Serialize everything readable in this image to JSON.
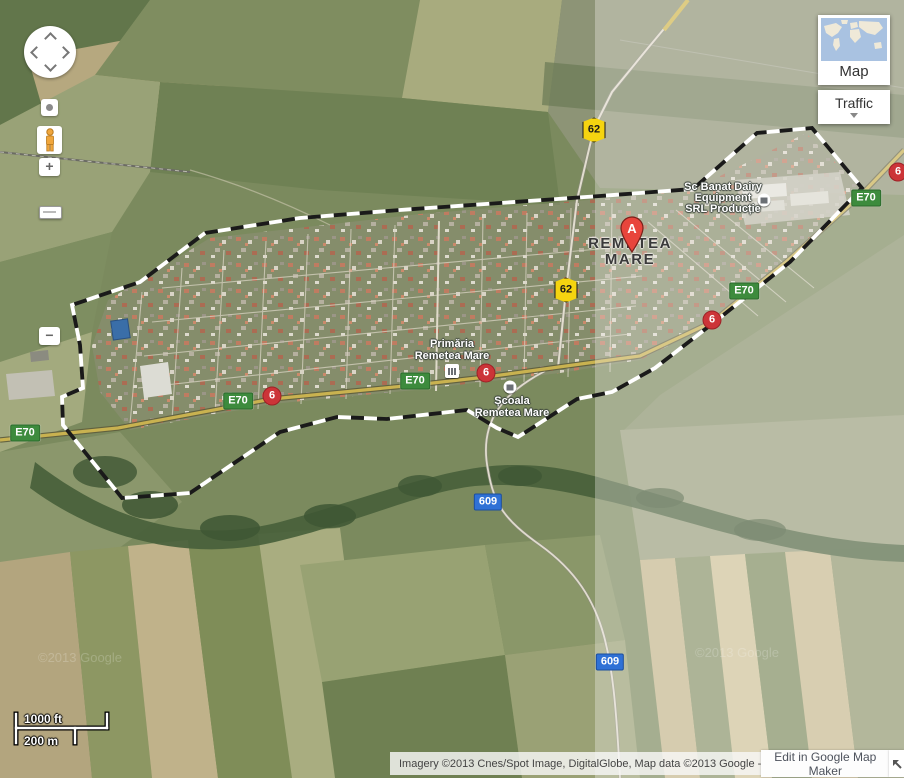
{
  "controls": {
    "zoom_in": "+",
    "zoom_out": "−"
  },
  "widgets": {
    "map_button": "Map",
    "traffic_button": "Traffic"
  },
  "road_badges": {
    "e70": "E70",
    "dn6": "6",
    "dn62": "62",
    "dj609": "609"
  },
  "marker": {
    "label": "A"
  },
  "place_labels": {
    "town_line1": "REMETEA",
    "town_line2": "MARE",
    "factory_line1": "Sc Banat Dairy",
    "factory_line2": "Equipment",
    "factory_line3": "SRL Producție",
    "cityhall_line1": "Primăria",
    "cityhall_line2": "Remetea Mare",
    "school_line1": "Școala",
    "school_line2": "Remetea Mare"
  },
  "scale_bar": {
    "imperial": "1000 ft",
    "metric": "200 m"
  },
  "attribution": {
    "imagery": "Imagery ©2013 Cnes/Spot Image, DigitalGlobe, Map data ©2013 Google -",
    "edit_button": "Edit in Google Map Maker"
  },
  "watermark": "©2013 Google",
  "colors": {
    "euro_badge": "#3d8b3d",
    "national_badge": "#cc3438",
    "county_badge": "#f5d410",
    "local_badge": "#2f71d6",
    "marker": "#e8453c"
  }
}
